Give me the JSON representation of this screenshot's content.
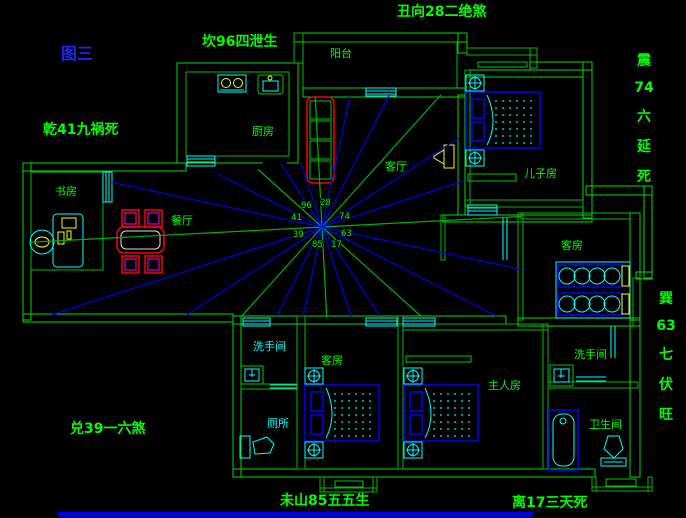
{
  "figure_label": "图三",
  "bagua_labels": {
    "top_left": "坎96四泄生",
    "top": "丑向28二绝煞",
    "left": "乾41九祸死",
    "right_upper": [
      "震",
      "74",
      "六",
      "延",
      "死"
    ],
    "right_lower": [
      "巽",
      "63",
      "七",
      "伏",
      "旺"
    ],
    "bottom_left": "兑39一六煞",
    "bottom_center": "未山85五五生",
    "bottom_right": "离17三天死"
  },
  "rooms": {
    "balcony": "阳台",
    "kitchen": "厨房",
    "living": "客厅",
    "sons_room": "儿子房",
    "study": "书房",
    "dining": "餐厅",
    "guest_room_ne": "客房",
    "washroom_w": "洗手间",
    "toilet_w": "厕所",
    "guest_room_s": "客房",
    "master_room": "主人房",
    "washroom_e": "洗手间",
    "bathroom_e": "卫生间"
  },
  "compass": {
    "center": {
      "x": 322,
      "y": 227
    },
    "ring_numbers": [
      {
        "t": "96",
        "x": 301,
        "y": 208
      },
      {
        "t": "28",
        "x": 320,
        "y": 205
      },
      {
        "t": "41",
        "x": 291,
        "y": 220
      },
      {
        "t": "74",
        "x": 339,
        "y": 219
      },
      {
        "t": "39",
        "x": 293,
        "y": 237
      },
      {
        "t": "63",
        "x": 341,
        "y": 236
      },
      {
        "t": "85",
        "x": 312,
        "y": 247
      },
      {
        "t": "17",
        "x": 331,
        "y": 247
      }
    ],
    "rays": [
      {
        "a": -3,
        "len": 200,
        "c": "green"
      },
      {
        "a": 12,
        "len": 204,
        "c": "blue"
      },
      {
        "a": 27,
        "len": 196,
        "c": "blue"
      },
      {
        "a": 42,
        "len": 133,
        "c": "green"
      },
      {
        "a": 57,
        "len": 106,
        "c": "blue"
      },
      {
        "a": 72,
        "len": 94,
        "c": "blue"
      },
      {
        "a": 87,
        "len": 90,
        "c": "green"
      },
      {
        "a": 102,
        "len": 91,
        "c": "blue"
      },
      {
        "a": 117,
        "len": 100,
        "c": "blue"
      },
      {
        "a": 132,
        "len": 120,
        "c": "green"
      },
      {
        "a": 147,
        "len": 163,
        "c": "blue"
      },
      {
        "a": 162,
        "len": 288,
        "c": "blue"
      },
      {
        "a": 177,
        "len": 291,
        "c": "green"
      },
      {
        "a": 192,
        "len": 215,
        "c": "blue"
      },
      {
        "a": 207,
        "len": 117,
        "c": "blue"
      },
      {
        "a": 222,
        "len": 86,
        "c": "green"
      },
      {
        "a": 237,
        "len": 76,
        "c": "blue"
      },
      {
        "a": 252,
        "len": 67,
        "c": "blue"
      },
      {
        "a": 267,
        "len": 130,
        "c": "green"
      },
      {
        "a": 282,
        "len": 135,
        "c": "blue"
      },
      {
        "a": 297,
        "len": 148,
        "c": "blue"
      },
      {
        "a": 312,
        "len": 178,
        "c": "green"
      },
      {
        "a": 327,
        "len": 165,
        "c": "blue"
      },
      {
        "a": 342,
        "len": 150,
        "c": "blue"
      }
    ]
  },
  "colors": {
    "wall_green": "#00dd00",
    "text_green": "#00ff00",
    "window_cyan": "#00ffff",
    "ray_blue": "#0000ee",
    "ray_green": "#00b400",
    "furniture_red": "#ff0000",
    "furniture_magenta": "#ff00ff",
    "furniture_yellow": "#ffff00",
    "bed_blue": "#0000ff",
    "figure_blue": "#2323ff",
    "bottom_bar_blue": "#0000d8"
  }
}
